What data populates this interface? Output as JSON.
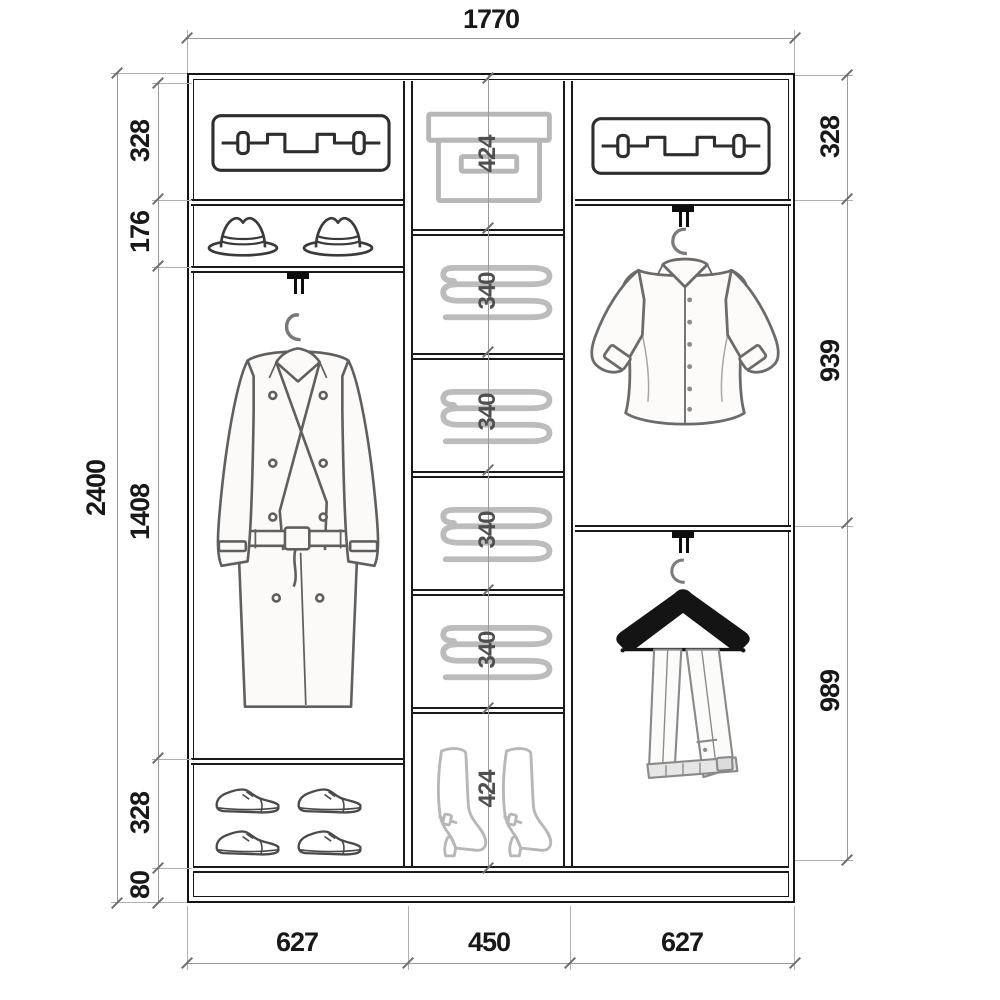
{
  "dimensions": {
    "total_width": "1770",
    "total_height": "2400",
    "left_column": [
      "328",
      "176",
      "1408",
      "328",
      "80"
    ],
    "center_column": [
      "424",
      "340",
      "340",
      "340",
      "340",
      "424"
    ],
    "right_column": [
      "328",
      "939",
      "989"
    ],
    "bottom": [
      "627",
      "450",
      "627"
    ]
  },
  "icons": {
    "left_column": [
      "suitcase-icon",
      "hats-icon",
      "coat-on-hanger-icon",
      "shoes-icon"
    ],
    "center_column": [
      "storage-box-icon",
      "folded-linen-icon",
      "folded-linen-icon",
      "folded-linen-icon",
      "folded-linen-icon",
      "boots-icon"
    ],
    "right_column": [
      "suitcase-icon",
      "shirt-on-hanger-icon",
      "trousers-on-hanger-icon"
    ]
  },
  "colors": {
    "background": "#ffffff",
    "frame": "#141414",
    "dimension_line": "#9a9a9a",
    "dimension_text": "#181818",
    "center_dimension_text": "#4f4f4f",
    "light_item_outline": "#b9b9b9",
    "dark_item_outline": "#3f3f3f"
  }
}
